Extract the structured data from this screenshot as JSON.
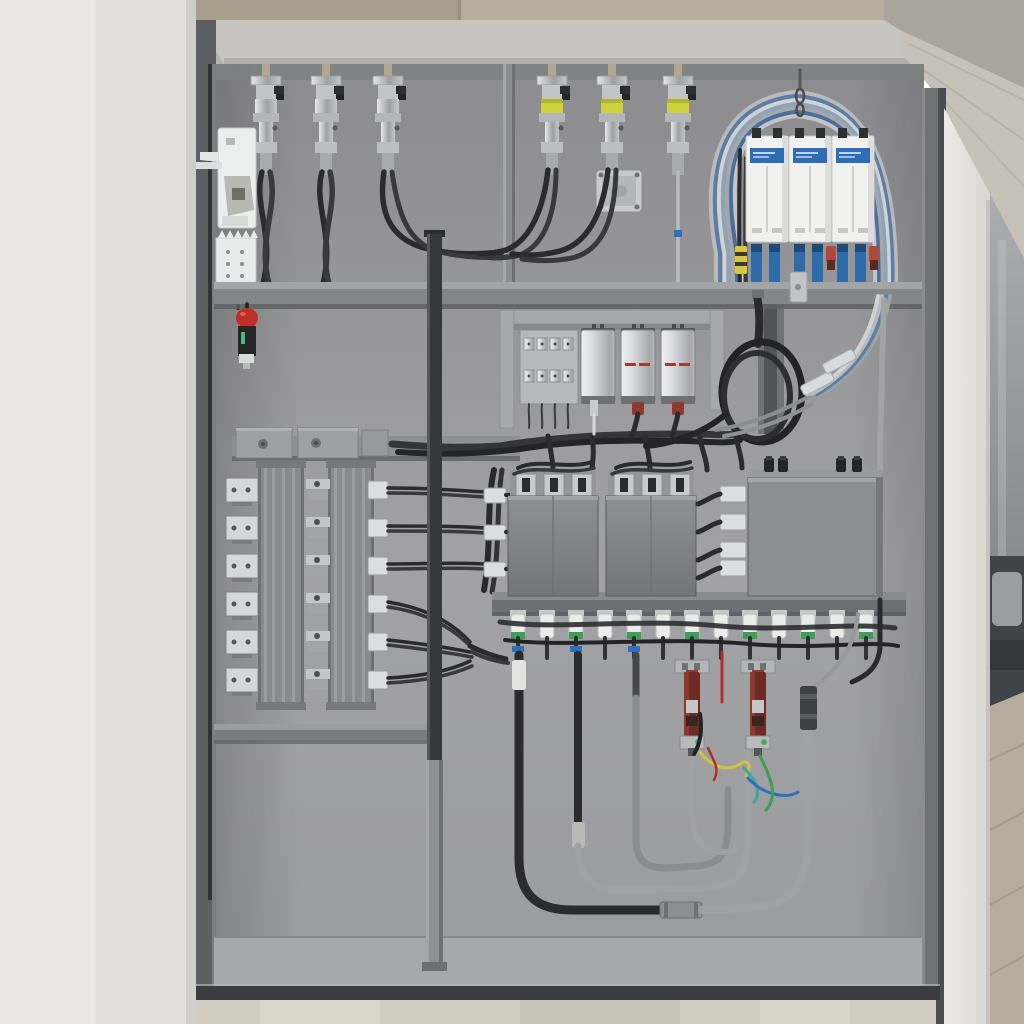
{
  "scene": {
    "kind": "industrial-electrical-enclosure-3d-render",
    "view": "open wall-mounted control cabinet with wired components, white wall at left, wood beam and room visible at right"
  },
  "palette": {
    "wall": "#e9e7e3",
    "wallShade": "#dcdad6",
    "wallLine": "#f0eeea",
    "beigeA": "#a89e8e",
    "beigeB": "#b7ad9d",
    "topRail": "#c6c5c1",
    "topRailSh": "#a9a8a4",
    "wood": "#c6c2ba",
    "woodDark": "#a9a59d",
    "woodGrain": "#b1ada3",
    "pillar": "#e6e4df",
    "pillarEdge": "#c6c4bf",
    "sofa": "#404347",
    "pillow": "#9b9da0",
    "roomFloor": "#b6ad9f",
    "roomGrain": "#a49a8b",
    "gap": "#4b4c4e",
    "leftWallIn": "#5e5f62",
    "rightWallIn": "#717274",
    "floorIn": "#a7a8aa",
    "sill": "#3a3b3d",
    "outFloor": "#d2ccc1",
    "shelfTop": "#a3a4a6",
    "shelfFront": "#858688",
    "shelfSh": "#5f6062",
    "railTop": "#8a8b8d",
    "railFront": "#6e6f71",
    "pole": "#37383a",
    "poleLight": "#8e8f91",
    "black": "#2b2b2d",
    "black2": "#39393b",
    "dark": "#242426",
    "gray": "#9fa1a3",
    "grayDark": "#8a8c8e",
    "metal": "#cdced0",
    "metalLight": "#d6d7d9",
    "metalDark": "#9a9b9d",
    "yellowGland": "#cdd13e",
    "modWhite": "#f1f1ef",
    "modLabel": "#2f6cb5",
    "blue": "#2d6ca8",
    "navy": "#1d4a78",
    "orangeRed": "#b04a36",
    "ferruleY": "#d6ca3c",
    "capRed": "#a5392e",
    "extr": "#898a8c",
    "extrRib": "#9e9fa1",
    "extrDark": "#6b6c6e",
    "silver": "#d2d3d5",
    "box": "#7f8083",
    "bigBox": "#8d8e90",
    "whiteC": "#dcdddf",
    "greenBand": "#3e9e58",
    "blueBand": "#2f6fc0",
    "redCap": "#bd2f27",
    "redBody": "#6e2a24",
    "redBody2": "#8c3a30",
    "wireY": "#d4c23e",
    "wireC": "#3aa8a0",
    "wireB": "#2f6fc0",
    "wireG": "#3f9c50",
    "wireR": "#b03028",
    "sleeve": "#e3e3e1",
    "ceramic": "#ecedeb",
    "archColors": [
      "#b8babc",
      "#5b7da6",
      "#d0d2d4",
      "#8fa3b8",
      "#a5a8aa",
      "#4a6f9e",
      "#c3c5c7"
    ]
  },
  "components": {
    "top_left_cable_glands": {
      "count": 3,
      "xs": [
        266,
        326,
        388
      ],
      "style": "nickel metal gland, twin black cables twisted down to shelf"
    },
    "top_mid_emc_glands": {
      "count": 3,
      "xs": [
        552,
        612,
        678
      ],
      "style": "metal gland with yellow band",
      "third_has_single_gray_cable": true
    },
    "junction_plate": {
      "x": 596,
      "y": 170,
      "w": 46,
      "h": 42
    },
    "door_interlock_bracket": {
      "x": 218,
      "y": 128
    },
    "multipole_terminal_block": {
      "x": 216,
      "y": 238,
      "poles": 5
    },
    "red_cap_sensor": {
      "x": 247,
      "y": 318
    },
    "din_modules": {
      "count": 3,
      "xs": [
        746,
        789,
        832
      ],
      "w": 42,
      "h": 106,
      "label_color": "#2f6cb5",
      "label_text_legible": false
    },
    "module_connectors": {
      "blue_boots_per_module": 2,
      "accent_colors": [
        "#d6ca3c",
        "#b04a36"
      ]
    },
    "cable_arch_strands": 7,
    "cable_coil": {
      "cx": 762,
      "cy": 392
    },
    "capacitors": {
      "count": 3,
      "xs": [
        598,
        638,
        678
      ],
      "red_line": [
        false,
        true,
        true
      ]
    },
    "mini_terminal_panel": {
      "x": 520,
      "y": 330,
      "terminals_per_row": 4,
      "rows": 2
    },
    "terminal_rows": {
      "count": 6,
      "ys": [
        490,
        528,
        566,
        604,
        642,
        680
      ]
    },
    "busbar_extrusions": {
      "count": 2,
      "xs": [
        258,
        328
      ],
      "y": 464,
      "h": 240
    },
    "contactor_boxes": {
      "count": 2,
      "xs": [
        508,
        606
      ],
      "y": 496,
      "w": 90,
      "h": 100
    },
    "junction_box_large": {
      "x": 748,
      "y": 478,
      "w": 134,
      "h": 118
    },
    "white_connectors_left": {
      "count": 3,
      "x": 484,
      "ys": [
        488,
        525,
        562
      ]
    },
    "white_connectors_mid": {
      "count": 4,
      "x": 720,
      "ys": [
        486,
        514,
        542,
        560
      ]
    },
    "bottom_glands": {
      "count": 13,
      "x0": 518,
      "step": 29,
      "green_band_idx": [
        0,
        2,
        4,
        6,
        8,
        10,
        12
      ],
      "blue_band_idx": [
        0,
        2,
        4
      ]
    },
    "fuse_holder_assemblies": {
      "count": 2,
      "xs": [
        692,
        758
      ]
    },
    "signal_wire_colors": [
      "#d4c23e",
      "#3aa8a0",
      "#2f6fc0",
      "#3f9c50",
      "#b03028"
    ]
  }
}
